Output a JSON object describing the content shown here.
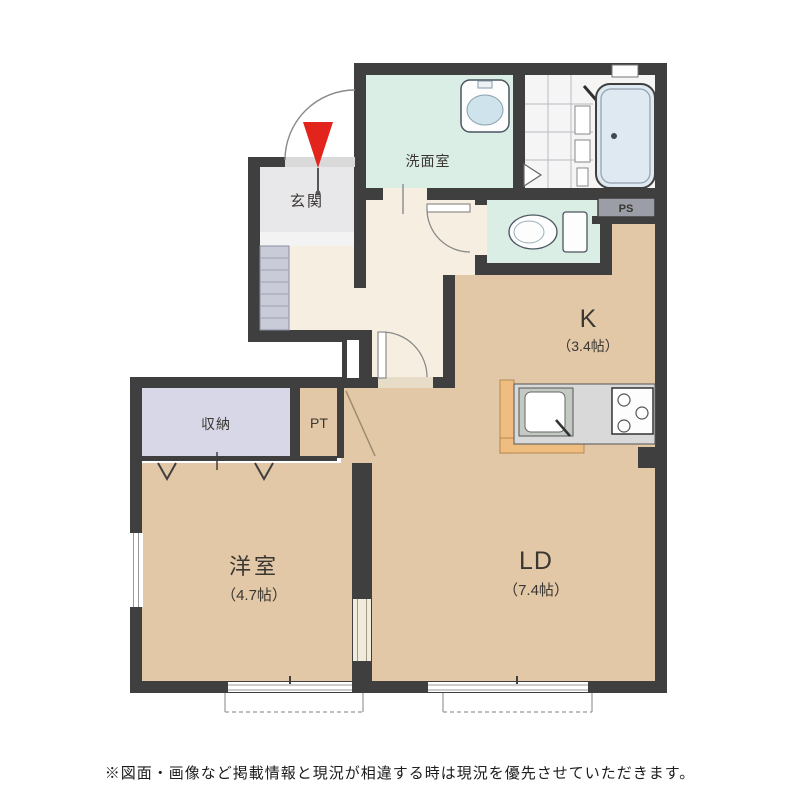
{
  "plan": {
    "rooms": {
      "genkan": {
        "label": "玄関"
      },
      "washroom": {
        "label": "洗面室"
      },
      "pipe_space": {
        "label": "PS"
      },
      "kitchen": {
        "label": "K",
        "size": "（3.4帖）"
      },
      "closet": {
        "label": "収納"
      },
      "pantry": {
        "label": "PT"
      },
      "western_room": {
        "label": "洋室",
        "size": "（4.7帖）"
      },
      "living_dining": {
        "label": "LD",
        "size": "（7.4帖）"
      }
    },
    "icons": {
      "entrance_arrow": "entrance-arrow-icon",
      "washbasin": "washbasin-icon",
      "bathtub": "bathtub-icon",
      "toilet": "toilet-icon",
      "kitchen_sink": "kitchen-sink-icon",
      "stove": "stove-icon"
    },
    "colors": {
      "wall": "#3f3f3f",
      "room_tan": "#e2c8a6",
      "hall_cream": "#f6efe1",
      "wet_area_teal": "#daeee6",
      "closet_lavender": "#d7d7e7",
      "entrance_gray": "#e8e8ea",
      "counter_orange": "#f0bd80",
      "bathtub_blue": "#dfe9f1",
      "entrance_arrow_red": "#e3241c"
    }
  },
  "footer": {
    "disclaimer": "※図面・画像など掲載情報と現況が相違する時は現況を優先させていただきます。"
  }
}
